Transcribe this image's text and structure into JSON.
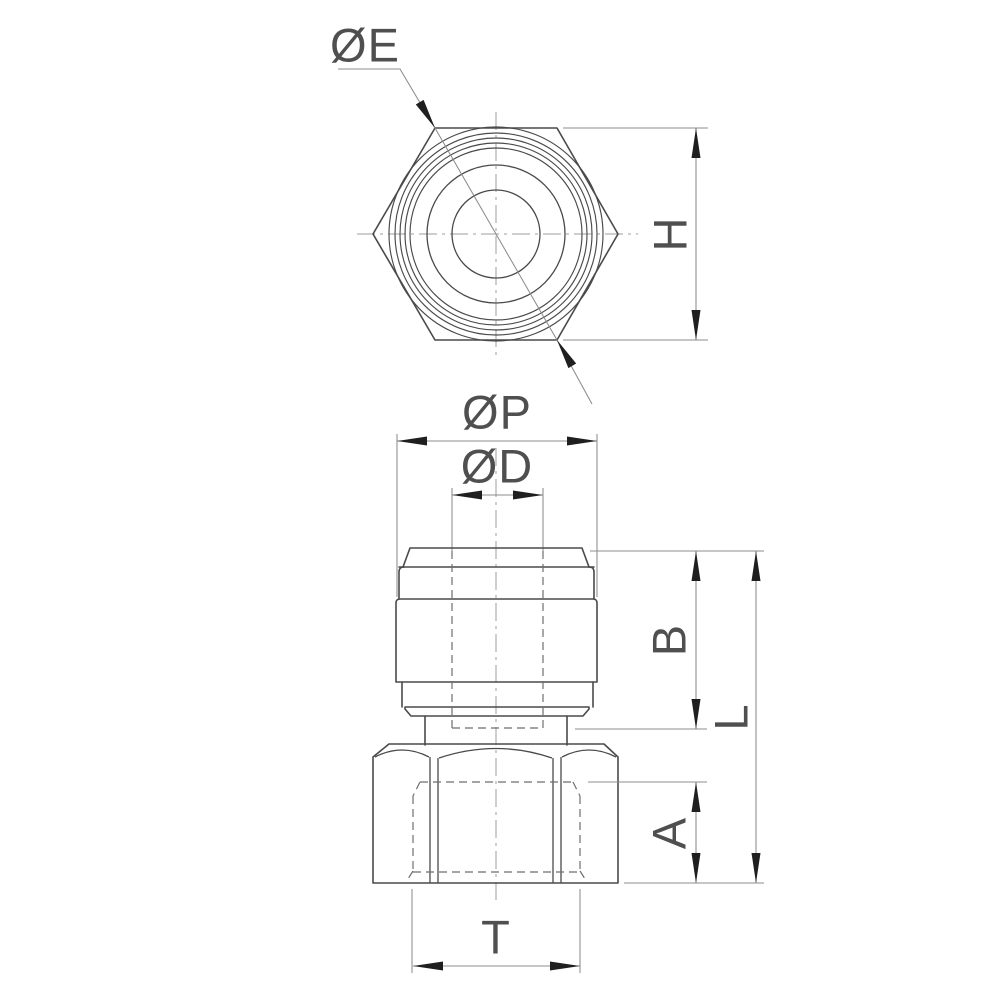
{
  "labels": {
    "dia_e": "ØE",
    "h": "H",
    "dia_p": "ØP",
    "dia_d": "ØD",
    "b": "B",
    "l": "L",
    "a": "A",
    "t": "T"
  },
  "colors": {
    "background": "#ffffff",
    "outline": "#4a4a4a",
    "dimension": "#8c8c8c",
    "hidden": "#6e6e6e",
    "centerline": "#9c9c9c",
    "arrow": "#1f1f1f",
    "text": "#4f4f4f"
  }
}
